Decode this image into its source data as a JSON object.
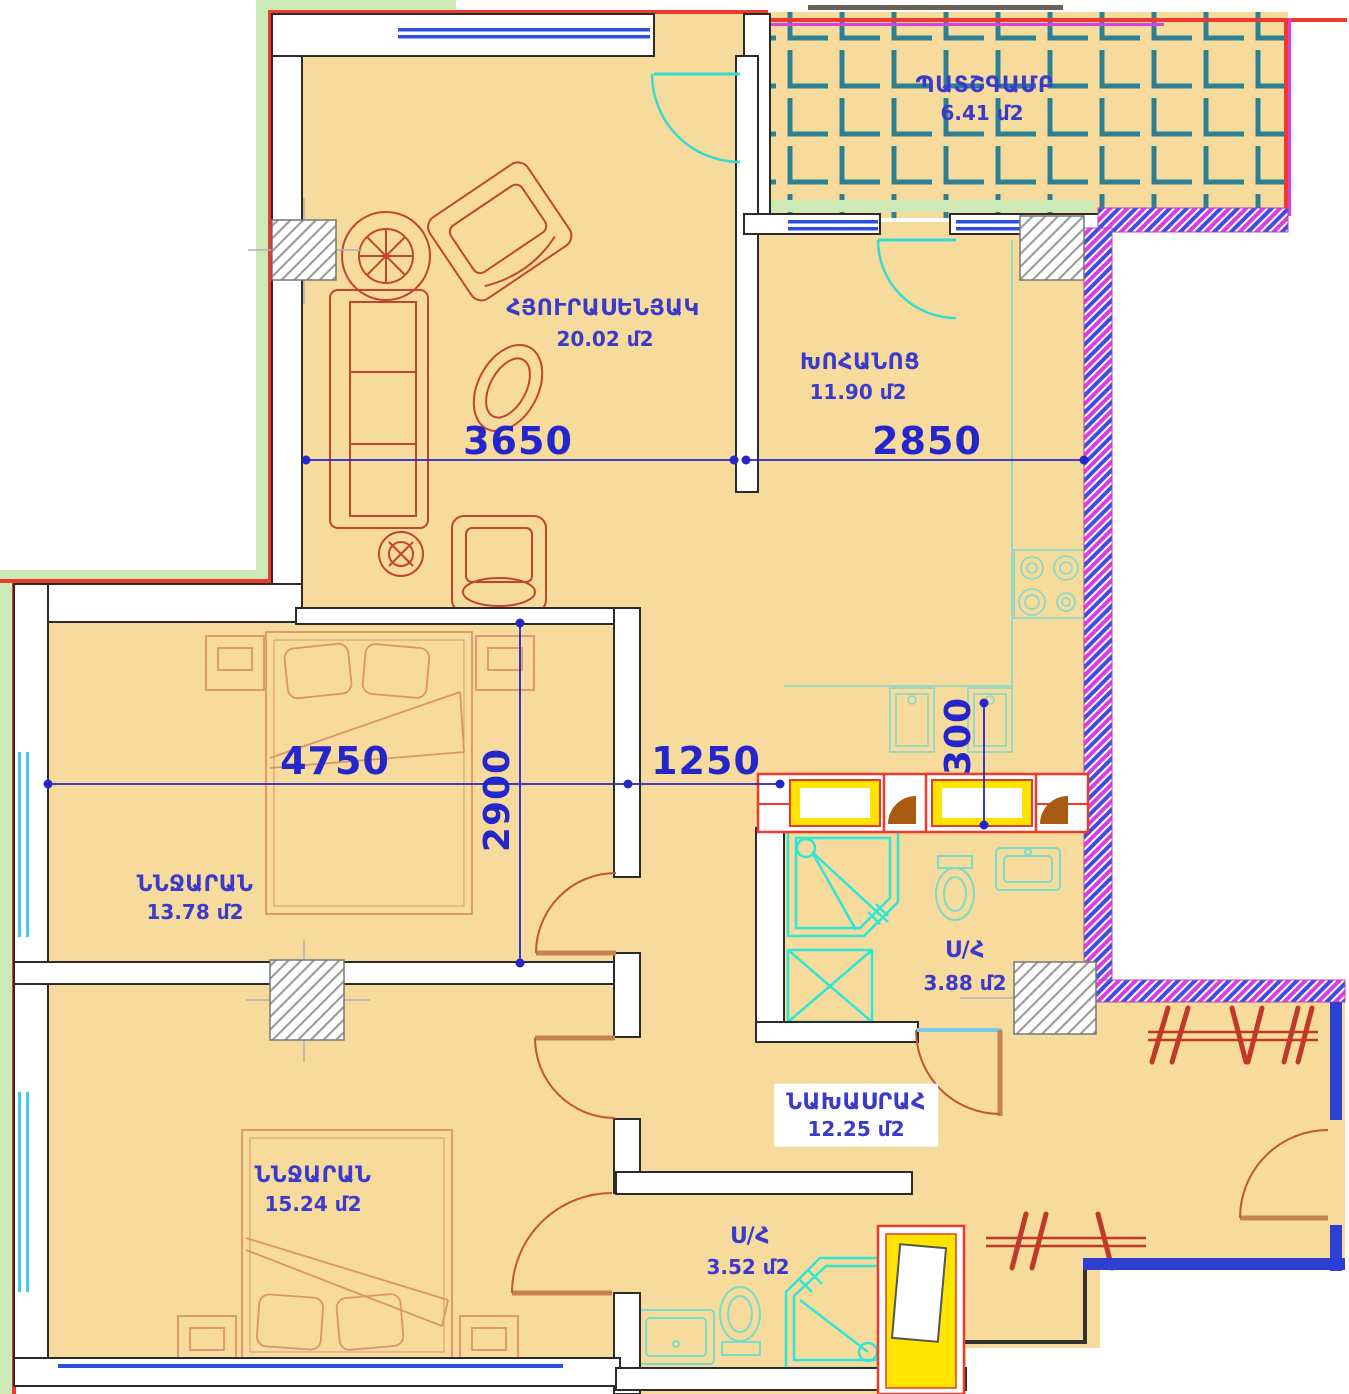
{
  "plan": {
    "rooms": {
      "living": {
        "name": "ՀՅՈՒՐԱՍԵՆՅԱԿ",
        "area": "20.02 մ2"
      },
      "kitchen": {
        "name": "ԽՈՀԱՆՈՑ",
        "area": "11.90 մ2"
      },
      "balcony": {
        "name": "ՊԱՏՇԳԱՄԲ",
        "area": "6.41 մ2"
      },
      "bedroom1": {
        "name": "ՆՆՋԱՐԱՆ",
        "area": "13.78 մ2"
      },
      "bedroom2": {
        "name": "ՆՆՋԱՐԱՆ",
        "area": "15.24 մ2"
      },
      "bath1": {
        "name": "Ս/Հ",
        "area": "3.88 մ2"
      },
      "bath2": {
        "name": "Ս/Հ",
        "area": "3.52 մ2"
      },
      "hall": {
        "name": "ՆԱԽԱՍՐԱՀ",
        "area": "12.25 մ2"
      }
    },
    "dimensions": {
      "living_width": "3650",
      "kitchen_width": "2850",
      "bedroom1_width": "4750",
      "bedroom1_depth": "2900",
      "corridor_width": "1250",
      "duct_width": "300"
    },
    "colors": {
      "floor": "#f6db9d",
      "dimension_blue": "#2525cc",
      "label_blue": "#3a3acc",
      "wall_outline": "#2b2b2b",
      "facade_red": "#ee3a2c",
      "facade_green": "#cde9b5",
      "fixture_cyan": "#2ee6d6",
      "fixture_soft_teal": "#7adbc8",
      "furniture_red": "#c2462f",
      "furniture_light": "#dc9468",
      "balcony_tile_teal": "#2d7f92",
      "hatch_blue": "#4449e0",
      "hatch_magenta": "#da3ee0",
      "window_blue": "#2b50e0",
      "duct_yellow": "#ffe400",
      "entry_wall_blue": "#2d3fd3"
    }
  }
}
